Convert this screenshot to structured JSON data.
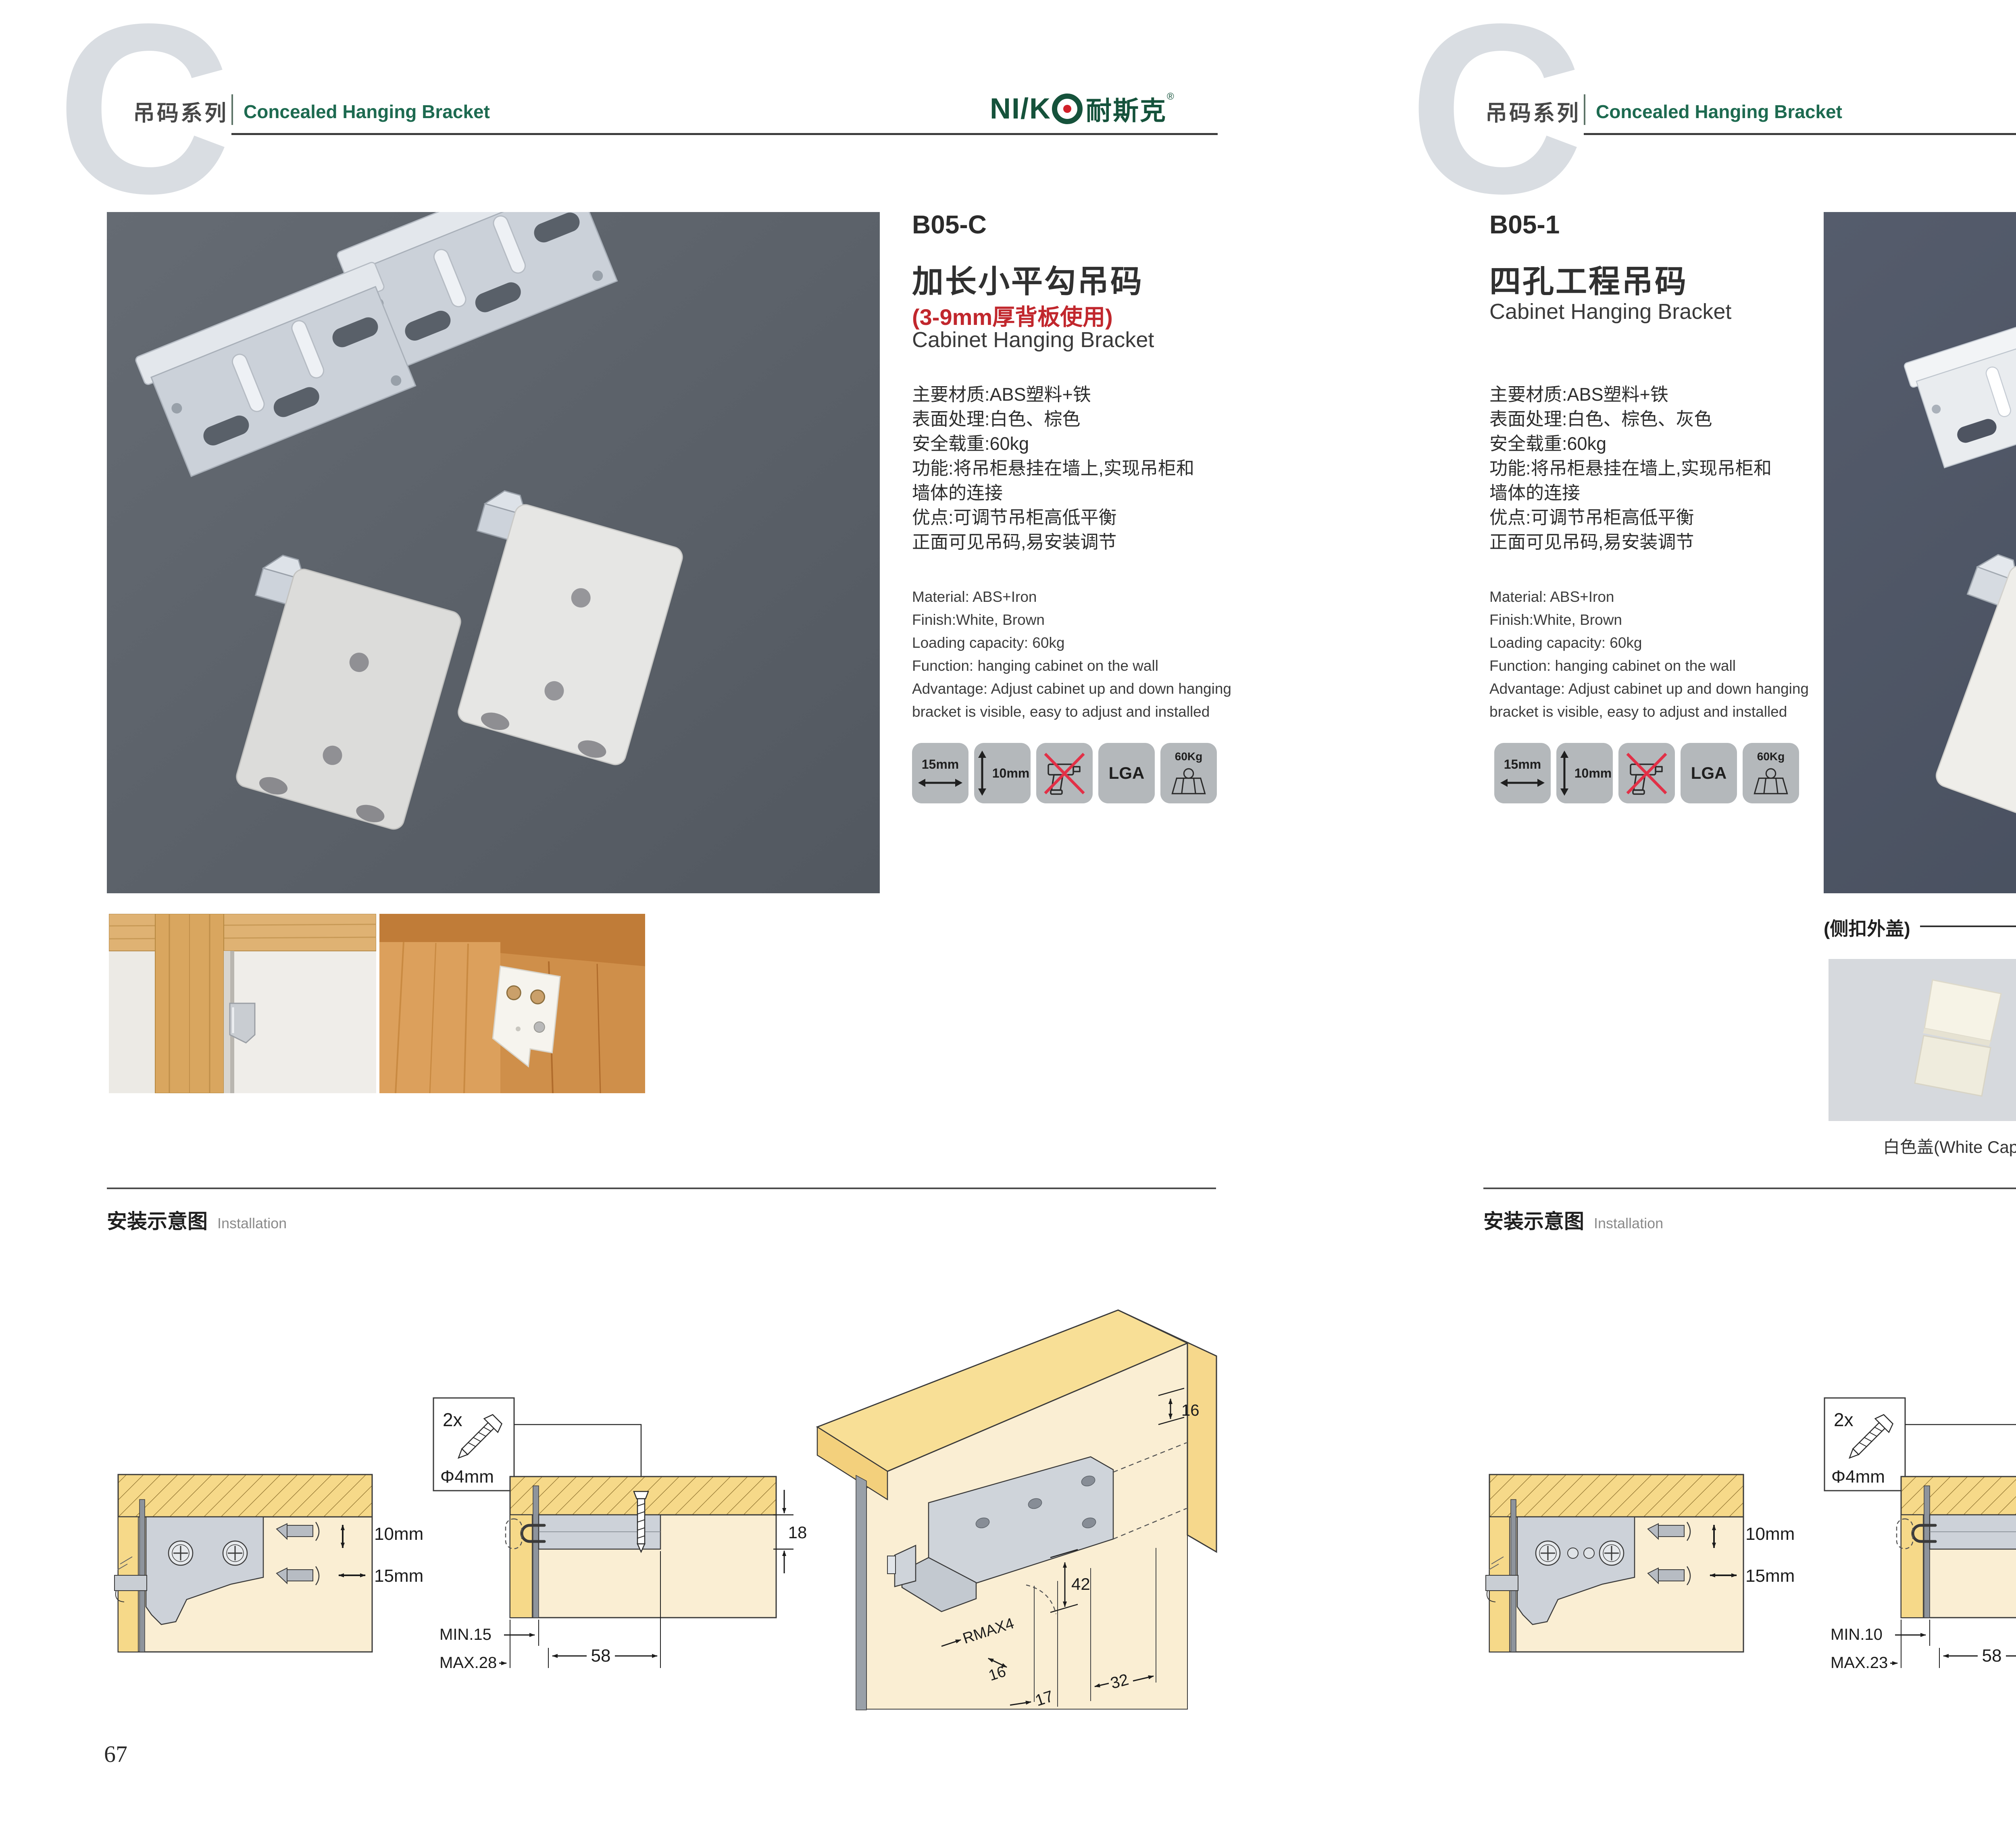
{
  "colors": {
    "brand_green": "#15523b",
    "header_green": "#1d6a50",
    "accent_red": "#c1272d",
    "badge_gray": "#b4b8bb",
    "logo_dot_red": "#d1202a"
  },
  "header": {
    "watermark": "C",
    "series_cn": "吊码系列",
    "series_en": "Concealed Hanging Bracket",
    "logo": {
      "latin": "NI/K",
      "cn": "耐斯克",
      "reg": "®"
    }
  },
  "left_page": {
    "code": "B05-C",
    "title_cn": "加长小平勾吊码",
    "subtitle_red": "(3-9mm厚背板使用)",
    "title_en": "Cabinet Hanging Bracket",
    "specs_cn": [
      "主要材质:ABS塑料+铁",
      "表面处理:白色、棕色",
      "安全载重:60kg",
      "功能:将吊柜悬挂在墙上,实现吊柜和",
      "墙体的连接",
      "优点:可调节吊柜高低平衡",
      "正面可见吊码,易安装调节"
    ],
    "specs_en": [
      "Material: ABS+Iron",
      "Finish:White, Brown",
      "Loading capacity: 60kg",
      "Function: hanging cabinet on the wall",
      "Advantage: Adjust cabinet up and down hanging",
      "bracket is visible, easy to adjust and installed"
    ],
    "page_number": "67"
  },
  "right_page": {
    "code": "B05-1",
    "title_cn": "四孔工程吊码",
    "title_en": "Cabinet Hanging Bracket",
    "specs_cn": [
      "主要材质:ABS塑料+铁",
      "表面处理:白色、棕色、灰色",
      "安全载重:60kg",
      "功能:将吊柜悬挂在墙上,实现吊柜和",
      "墙体的连接",
      "优点:可调节吊柜高低平衡",
      "正面可见吊码,易安装调节"
    ],
    "specs_en": [
      "Material: ABS+Iron",
      "Finish:White, Brown",
      "Loading capacity: 60kg",
      "Function: hanging cabinet on the wall",
      "Advantage: Adjust cabinet up and down hanging",
      "bracket is visible, easy to adjust and installed"
    ],
    "caps_label": "(侧扣外盖)",
    "caps": [
      "白色盖(White Cap)",
      "灰色盖(Gray Cap)",
      "棕色盖(Silver Cap)"
    ],
    "page_number": "68"
  },
  "badges": {
    "horizontal": "15mm",
    "vertical": "10mm",
    "lga": "LGA",
    "load": "60Kg"
  },
  "installation": {
    "title_cn": "安装示意图",
    "title_en": "Installation",
    "dims": {
      "v": "10mm",
      "h": "15mm",
      "count": "2x",
      "dia": "Φ4mm",
      "t": "18",
      "span": "58",
      "d16": "16",
      "d42": "42",
      "rmax": "RMAX4",
      "d16b": "16",
      "d17": "17",
      "d32": "32"
    },
    "left": {
      "min": "MIN.15",
      "max": "MAX.28"
    },
    "right": {
      "min": "MIN.10",
      "max": "MAX.23"
    }
  }
}
